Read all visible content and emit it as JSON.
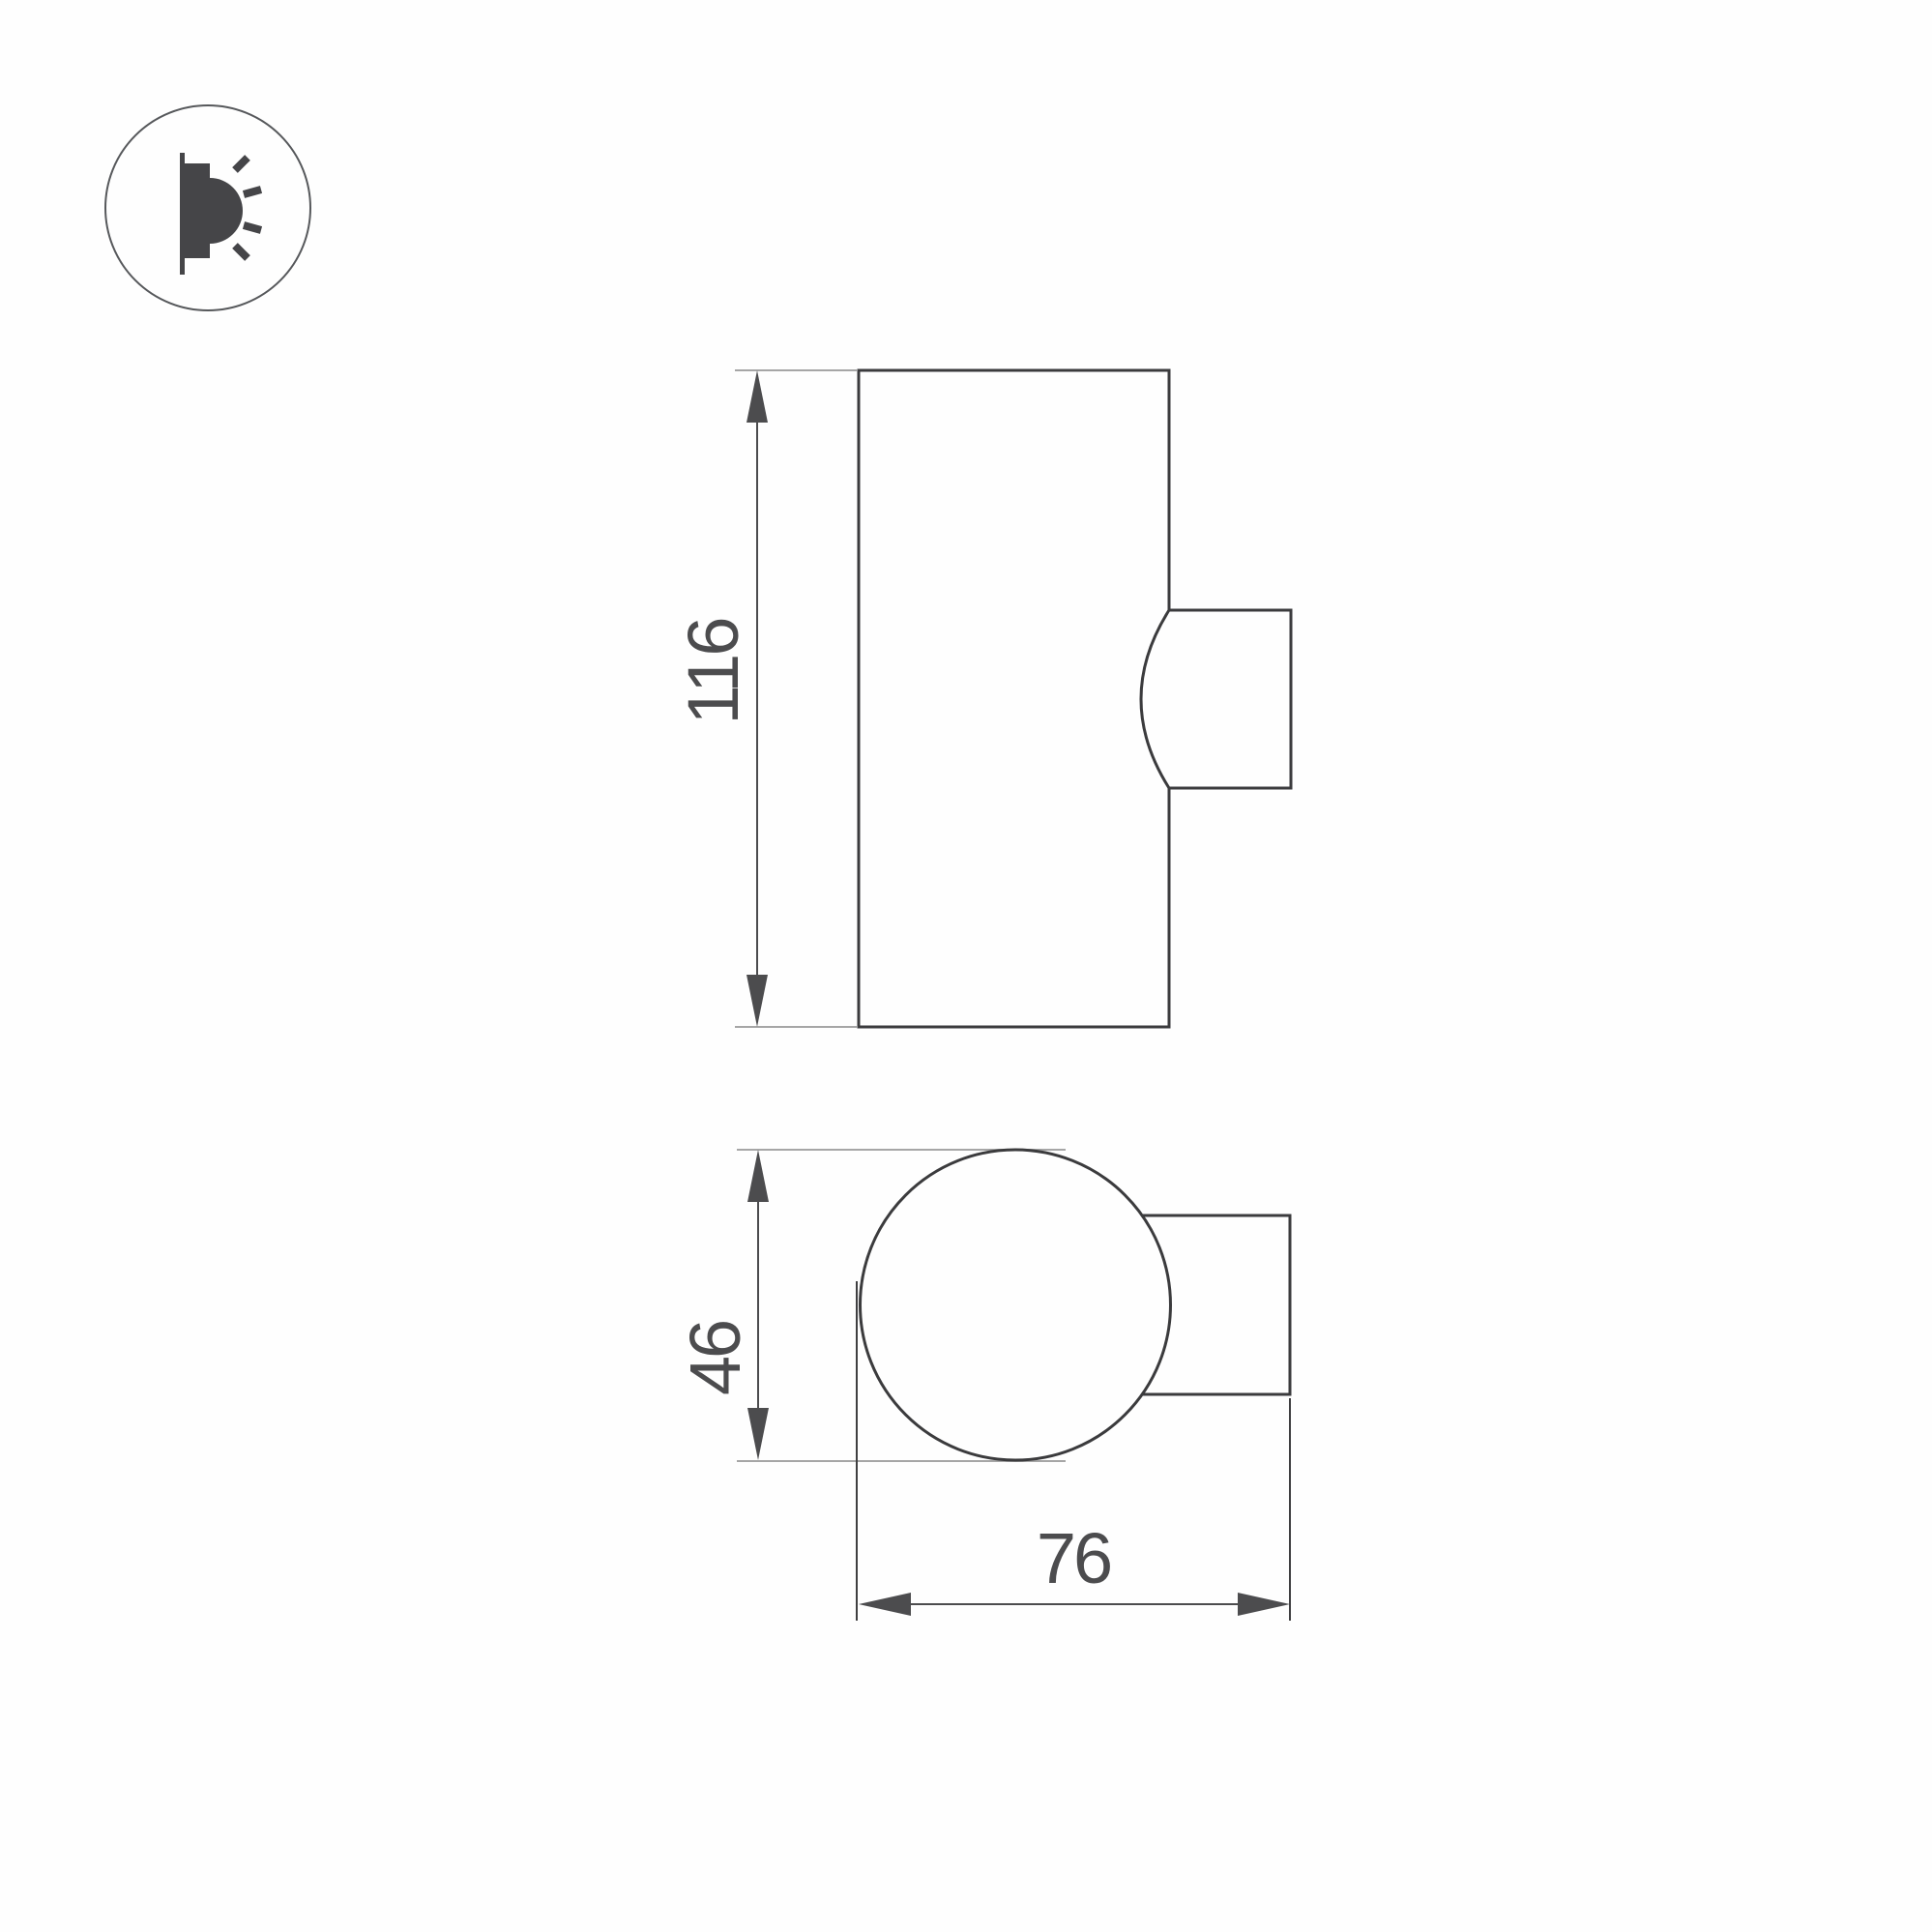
{
  "icons": {
    "badge": "wall-light-emission-icon"
  },
  "drawing": {
    "side_view": {
      "height_label": "116"
    },
    "plan_view": {
      "diameter_label": "46",
      "depth_label": "76"
    }
  },
  "colors": {
    "background": "#fefefe",
    "outline": "#3b3b3d",
    "dimension": "#4c4c4e",
    "extension_light": "#a6a6a6",
    "extension_dark": "#3f3f41",
    "icon_glyph": "#454548",
    "icon_circle": "#56585b"
  }
}
